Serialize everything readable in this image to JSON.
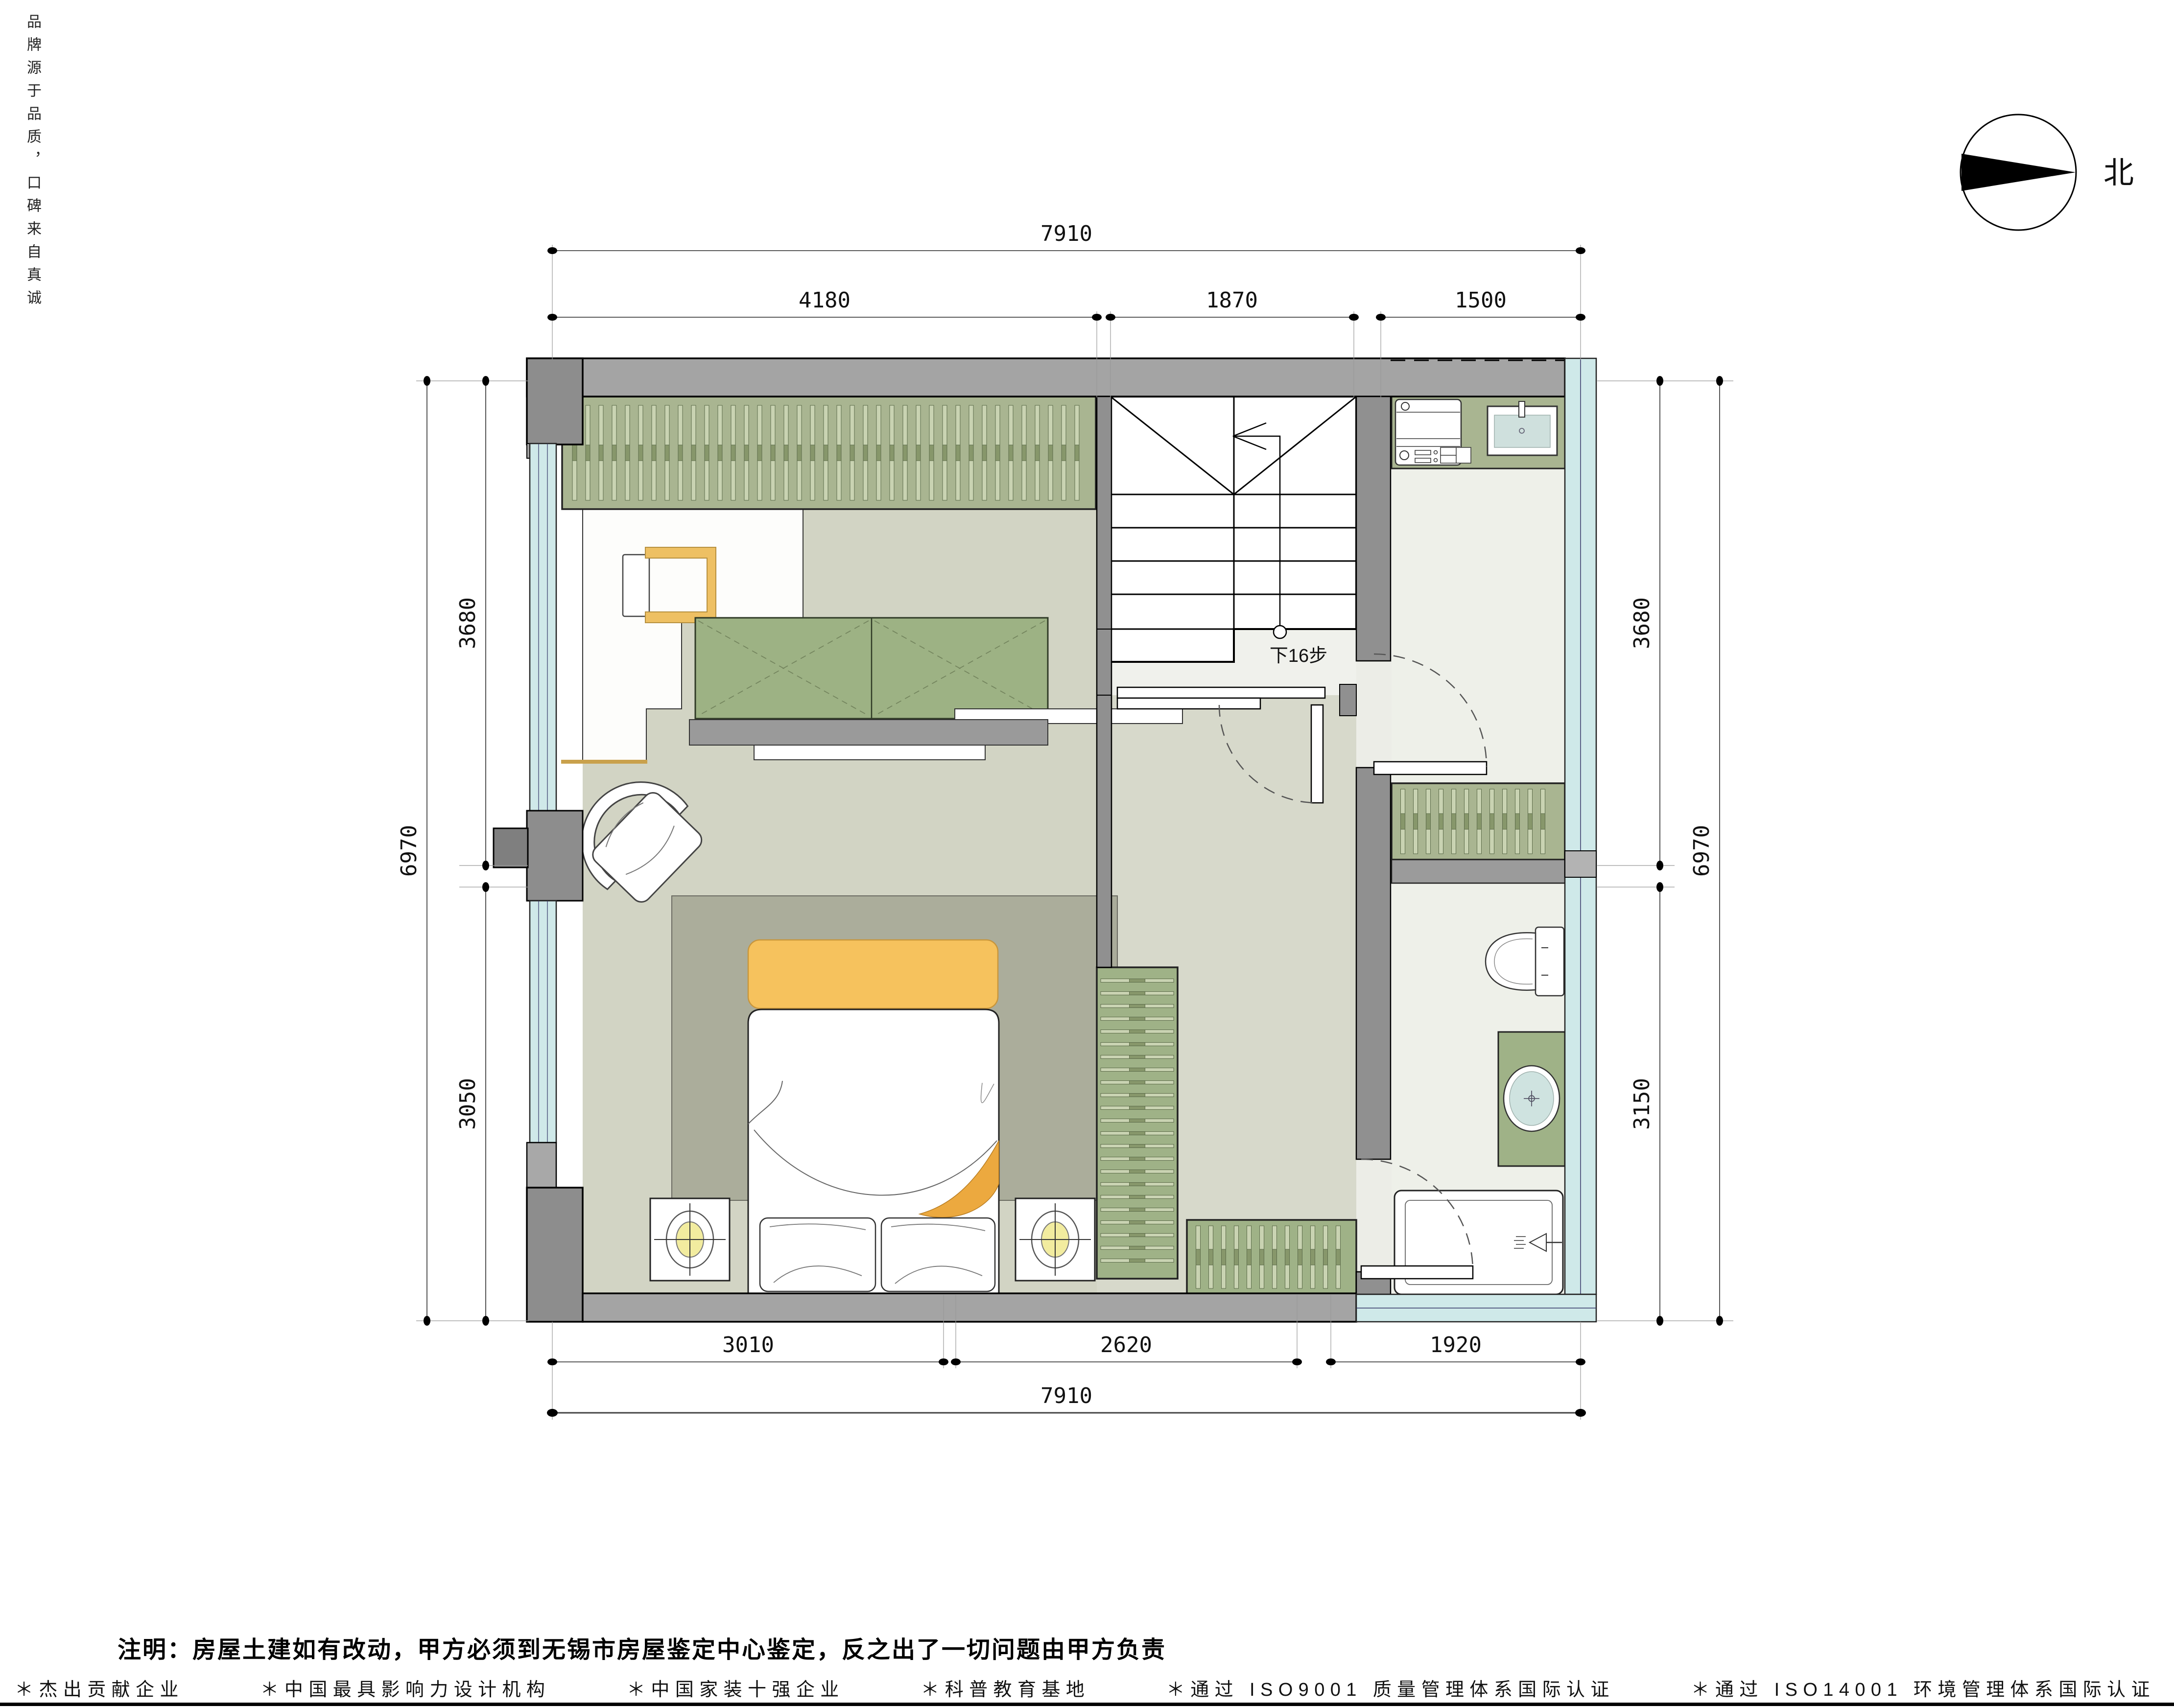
{
  "page": {
    "brand_vertical": "品牌源于品质，口碑来自真诚",
    "note": "注明：房屋土建如有改动，甲方必须到无锡市房屋鉴定中心鉴定，反之出了一切问题由甲方负责",
    "north_label": "北"
  },
  "plan": {
    "stair_note": "下16步"
  },
  "dims": {
    "top_overall": "7910",
    "top": [
      "4180",
      "1870",
      "1500"
    ],
    "bottom": [
      "3010",
      "2620",
      "1920"
    ],
    "bottom_overall": "7910",
    "left": [
      "3680",
      "3050"
    ],
    "left_overall": "6970",
    "right": [
      "3680",
      "3150"
    ],
    "right_overall": "6970"
  },
  "footer": {
    "items": [
      "＊杰出贡献企业",
      "＊中国最具影响力设计机构",
      "＊中国家装十强企业",
      "＊科普教育基地",
      "＊通过 ISO9001 质量管理体系国际认证",
      "＊通过 ISO14001 环境管理体系国际认证"
    ]
  },
  "colors": {
    "wall_gray": "#a4a4a4",
    "wall_dark": "#8d8d8d",
    "cabinet_green": "#a9b591",
    "floor_green": "#d2d4c4",
    "floor_light": "#eef0e9",
    "window_glass": "#cfe9e9",
    "rug_gray": "#abad9b",
    "accent_orange": "#f6c25d",
    "lamp_yellow": "#f2ec9f"
  }
}
